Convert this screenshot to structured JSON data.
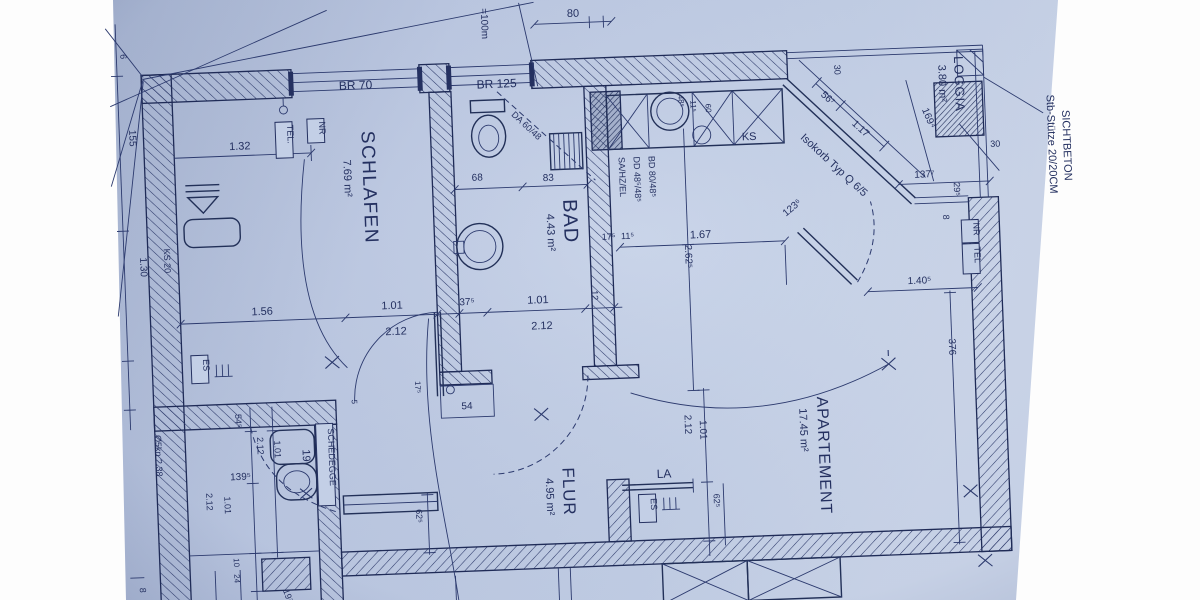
{
  "colors": {
    "paper": "#b7c3dd",
    "ink": "#243060",
    "background": "#ffffff"
  },
  "rooms": [
    {
      "name": "SCHLAFEN",
      "area": "7.69 m²"
    },
    {
      "name": "BAD",
      "area": "4.43 m²"
    },
    {
      "name": "FLUR",
      "area": "4.95 m²"
    },
    {
      "name": "APARTEMENT",
      "area": "17.45 m²"
    },
    {
      "name": "LOGGIA",
      "area": "3.80 m²"
    }
  ],
  "labels": {
    "br70": "BR 70",
    "br125": "BR 125",
    "tel_bed": "TEL.",
    "nr_bed": "NR",
    "es_bed": "ES",
    "ks20": "KS 20",
    "ks": "KS",
    "sa": "SA/HZ/EL",
    "dd": "DD 48⁵/48⁵",
    "bd": "BD 80/48⁵",
    "da": "DA 60/48",
    "isokorb": "Isokorb Typ Q 6/5",
    "stb1": "Stb-Stütze 20/20CM",
    "stb2": "SICHTBETON",
    "schedegge": "SCHEDEGGE",
    "la": "LA",
    "es_flur": "ES",
    "nr_wall": "NR",
    "tel_wall": "TEL",
    "wc": "19",
    "scale": "=100m"
  },
  "dims": {
    "top80": "80",
    "d6": "6",
    "d155": "155",
    "d130": "1.30",
    "d132": "1.32",
    "d156": "1.56",
    "d101a": "1.01",
    "d212a": "2.12",
    "d375": "37⁵",
    "d101b": "1.01",
    "d212b": "2.12",
    "d12": "12",
    "d68": "68",
    "d83": "83",
    "d175k": "17⁵",
    "d115k": "11⁵",
    "d485": "48⁵",
    "d115s": "11⁵",
    "d60": "60",
    "d167": "1.67",
    "d2625": "2.62⁵",
    "d1236": "123⁶",
    "d567": "56⁷",
    "d117": "1.17",
    "d30a": "30",
    "d30b": "30",
    "d1694": "169⁴",
    "d1377": "137⁷",
    "d295": "29⁵",
    "d8a": "8",
    "d1405": "1.40⁵",
    "d376": "376",
    "d212c": "2.12",
    "d101d": "1.01",
    "d625a": "62⁵",
    "d625b": "62⁵",
    "d54": "54",
    "d175f": "17⁵",
    "d5": "5",
    "d545": "54⁵",
    "d1395": "139⁵",
    "d212d": "2.12",
    "d101e": "1.01",
    "d212e": "2.12",
    "d101f": "1.01",
    "d10": "10",
    "d24": "24",
    "d197": "19⁷",
    "d238": "Ø5kn 2.38",
    "d8b": "8"
  }
}
